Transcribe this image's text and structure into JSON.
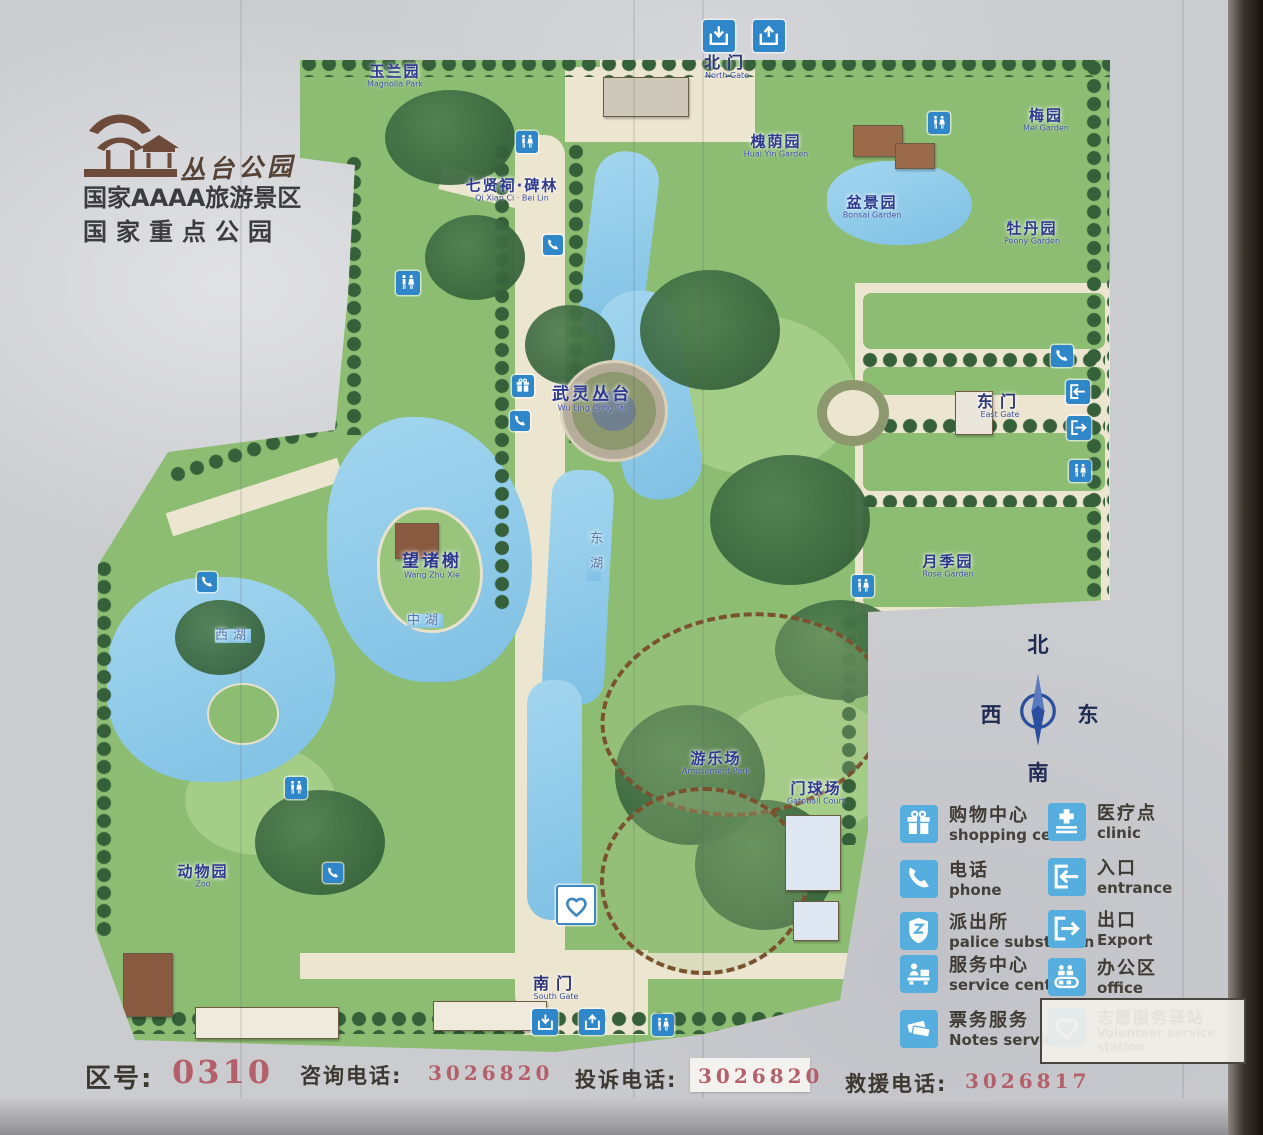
{
  "park": {
    "name_script": "丛台公园",
    "rating_line1": "国家AAAA旅游景区",
    "rating_line2": "国家重点公园"
  },
  "map": {
    "compass": {
      "n": "北",
      "s": "南",
      "e": "东",
      "w": "西"
    },
    "labels": [
      {
        "zh": "玉兰园",
        "en": "Magnolia Park",
        "x": 395,
        "y": 76,
        "kind": "garden"
      },
      {
        "zh": "北门",
        "en": "North Gate",
        "x": 727,
        "y": 67,
        "kind": "gate"
      },
      {
        "zh": "梅园",
        "en": "Mei Garden",
        "x": 1046,
        "y": 120,
        "kind": "garden"
      },
      {
        "zh": "槐荫园",
        "en": "Huai Yin Garden",
        "x": 776,
        "y": 146,
        "kind": "garden"
      },
      {
        "zh": "盆景园",
        "en": "Bonsai Garden",
        "x": 872,
        "y": 207,
        "kind": "garden"
      },
      {
        "zh": "牡丹园",
        "en": "Peony Garden",
        "x": 1032,
        "y": 233,
        "kind": "garden"
      },
      {
        "zh": "七贤祠·碑林",
        "en": "Qi Xian Ci · Bei Lin",
        "x": 512,
        "y": 190,
        "kind": "garden"
      },
      {
        "zh": "武灵丛台",
        "en": "Wu Ling Cong Tai",
        "x": 592,
        "y": 399,
        "kind": "site"
      },
      {
        "zh": "东门",
        "en": "East Gate",
        "x": 1000,
        "y": 406,
        "kind": "gate"
      },
      {
        "zh": "望诸榭",
        "en": "Wang Zhu Xie",
        "x": 432,
        "y": 566,
        "kind": "site"
      },
      {
        "zh": "月季园",
        "en": "Rose Garden",
        "x": 948,
        "y": 566,
        "kind": "garden"
      },
      {
        "zh": "西湖",
        "en": "",
        "x": 233,
        "y": 636,
        "kind": "water"
      },
      {
        "zh": "中湖",
        "en": "",
        "x": 425,
        "y": 621,
        "kind": "water"
      },
      {
        "zh": "东湖",
        "en": "",
        "x": 594,
        "y": 556,
        "kind": "water vertical"
      },
      {
        "zh": "游乐场",
        "en": "Amusement Park",
        "x": 716,
        "y": 763,
        "kind": "garden"
      },
      {
        "zh": "门球场",
        "en": "Gateball Court",
        "x": 816,
        "y": 793,
        "kind": "garden"
      },
      {
        "zh": "动物园",
        "en": "Zoo",
        "x": 203,
        "y": 876,
        "kind": "garden"
      },
      {
        "zh": "南门",
        "en": "South Gate",
        "x": 556,
        "y": 988,
        "kind": "gate"
      }
    ],
    "icons": [
      {
        "type": "arrow-down-icon",
        "x": 719,
        "y": 36,
        "s": 32
      },
      {
        "type": "arrow-up-icon",
        "x": 769,
        "y": 36,
        "s": 32
      },
      {
        "type": "toilet-icon",
        "x": 527,
        "y": 142,
        "s": 22
      },
      {
        "type": "toilet-icon",
        "x": 939,
        "y": 123,
        "s": 22
      },
      {
        "type": "phone-icon",
        "x": 553,
        "y": 245,
        "s": 20
      },
      {
        "type": "toilet-icon",
        "x": 408,
        "y": 283,
        "s": 24
      },
      {
        "type": "gift-icon",
        "x": 523,
        "y": 386,
        "s": 22
      },
      {
        "type": "phone-icon",
        "x": 520,
        "y": 421,
        "s": 20
      },
      {
        "type": "phone-icon",
        "x": 1062,
        "y": 356,
        "s": 22
      },
      {
        "type": "entrance-icon",
        "x": 1078,
        "y": 392,
        "s": 24
      },
      {
        "type": "exit-icon",
        "x": 1079,
        "y": 428,
        "s": 24
      },
      {
        "type": "toilet-icon",
        "x": 1080,
        "y": 471,
        "s": 22
      },
      {
        "type": "toilet-icon",
        "x": 863,
        "y": 586,
        "s": 22
      },
      {
        "type": "phone-icon",
        "x": 207,
        "y": 582,
        "s": 20
      },
      {
        "type": "toilet-icon",
        "x": 296,
        "y": 788,
        "s": 22
      },
      {
        "type": "phone-icon",
        "x": 333,
        "y": 873,
        "s": 20
      },
      {
        "type": "heart-icon",
        "x": 576,
        "y": 905,
        "s": 36,
        "variant": "light"
      },
      {
        "type": "arrow-down-icon",
        "x": 545,
        "y": 1022,
        "s": 26
      },
      {
        "type": "arrow-up-icon",
        "x": 592,
        "y": 1022,
        "s": 26
      },
      {
        "type": "toilet-icon",
        "x": 663,
        "y": 1025,
        "s": 22
      }
    ]
  },
  "legend": {
    "columns": [
      [
        {
          "icon": "gift-icon",
          "zh": "购物中心",
          "en": "shopping ceter",
          "x": 900,
          "y": 805
        },
        {
          "icon": "phone-icon",
          "zh": "电话",
          "en": "phone",
          "x": 900,
          "y": 860
        },
        {
          "icon": "police-icon",
          "zh": "派出所",
          "en": "palice substation",
          "x": 900,
          "y": 912
        },
        {
          "icon": "service-icon",
          "zh": "服务中心",
          "en": "service center",
          "x": 900,
          "y": 955
        },
        {
          "icon": "ticket-icon",
          "zh": "票务服务",
          "en": "Notes services",
          "x": 900,
          "y": 1010
        }
      ],
      [
        {
          "icon": "clinic-icon",
          "zh": "医疗点",
          "en": "clinic",
          "x": 1048,
          "y": 803
        },
        {
          "icon": "entrance-icon",
          "zh": "入口",
          "en": "entrance",
          "x": 1048,
          "y": 858
        },
        {
          "icon": "exit-icon",
          "zh": "出口",
          "en": "Export",
          "x": 1048,
          "y": 910
        },
        {
          "icon": "office-icon",
          "zh": "办公区",
          "en": "office",
          "x": 1048,
          "y": 958
        },
        {
          "icon": "heart-icon",
          "zh": "志愿服务驿站",
          "en": "Volunteer service station",
          "x": 1048,
          "y": 1008,
          "boxed": true
        }
      ]
    ]
  },
  "footer": {
    "area_code_label": "区号:",
    "area_code": "0310",
    "consult_label": "咨询电话:",
    "consult_number": "3026820",
    "complaint_label": "投诉电话:",
    "complaint_number": "3026820",
    "rescue_label": "救援电话:",
    "rescue_number": "3026817"
  },
  "colors": {
    "map_icon_blue": "#2f86c8",
    "legend_icon_blue": "#55aede",
    "label_blue": "#2e3a8e",
    "number_red": "#b4606a",
    "logo_brown": "#6d4a39",
    "lawn_green": "#8cbd72",
    "lake_blue": "#8ccbea"
  }
}
